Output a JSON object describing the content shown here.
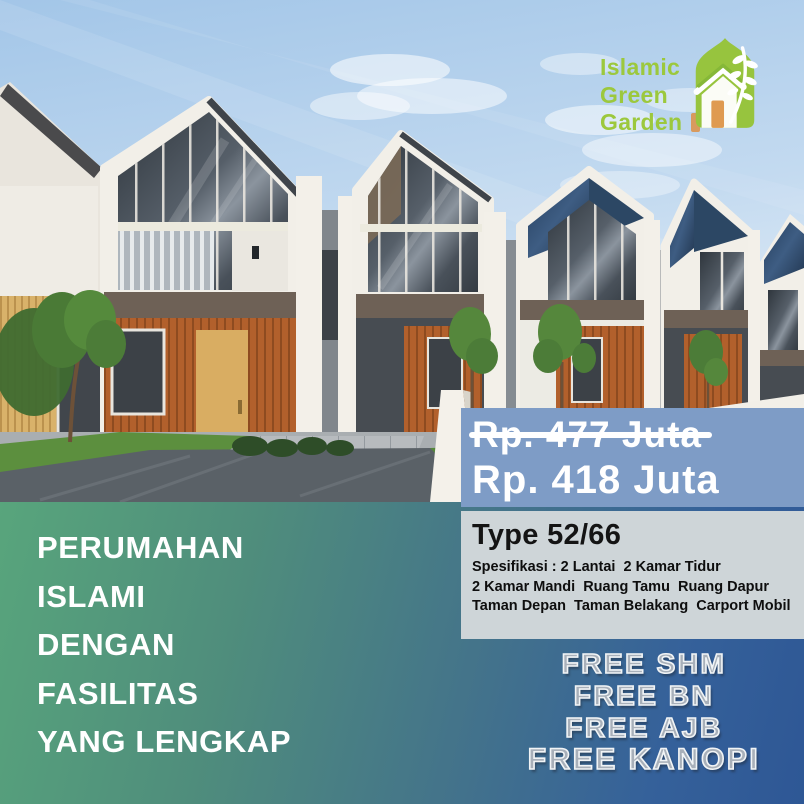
{
  "logo": {
    "line1": "Islamic",
    "line2": "Green",
    "line3": "Garden"
  },
  "pricing": {
    "old_price": "Rp. 477 Juta",
    "new_price": "Rp. 418 Juta"
  },
  "specs": {
    "type": "Type 52/66",
    "line1": "Spesifikasi : 2 Lantai  2 Kamar Tidur",
    "line2": "2 Kamar Mandi  Ruang Tamu  Ruang Dapur",
    "line3": "Taman Depan  Taman Belakang  Carport Mobil"
  },
  "headline": {
    "line1": "PERUMAHAN",
    "line2": "ISLAMI",
    "line3": "DENGAN",
    "line4": "FASILITAS",
    "line5": "YANG LENGKAP"
  },
  "freebies": [
    "FREE SHM",
    "FREE BN",
    "FREE AJB",
    "FREE KANOPI"
  ],
  "colors": {
    "price_panel": "#7e9cc6",
    "spec_panel": "#ced5d8",
    "band_green": "#58a57c",
    "band_blue": "#2e5795",
    "logo_green": "#9cc83d",
    "logo_door_orange": "#d89a5e",
    "freebie_gray": "#a8b0ba"
  }
}
